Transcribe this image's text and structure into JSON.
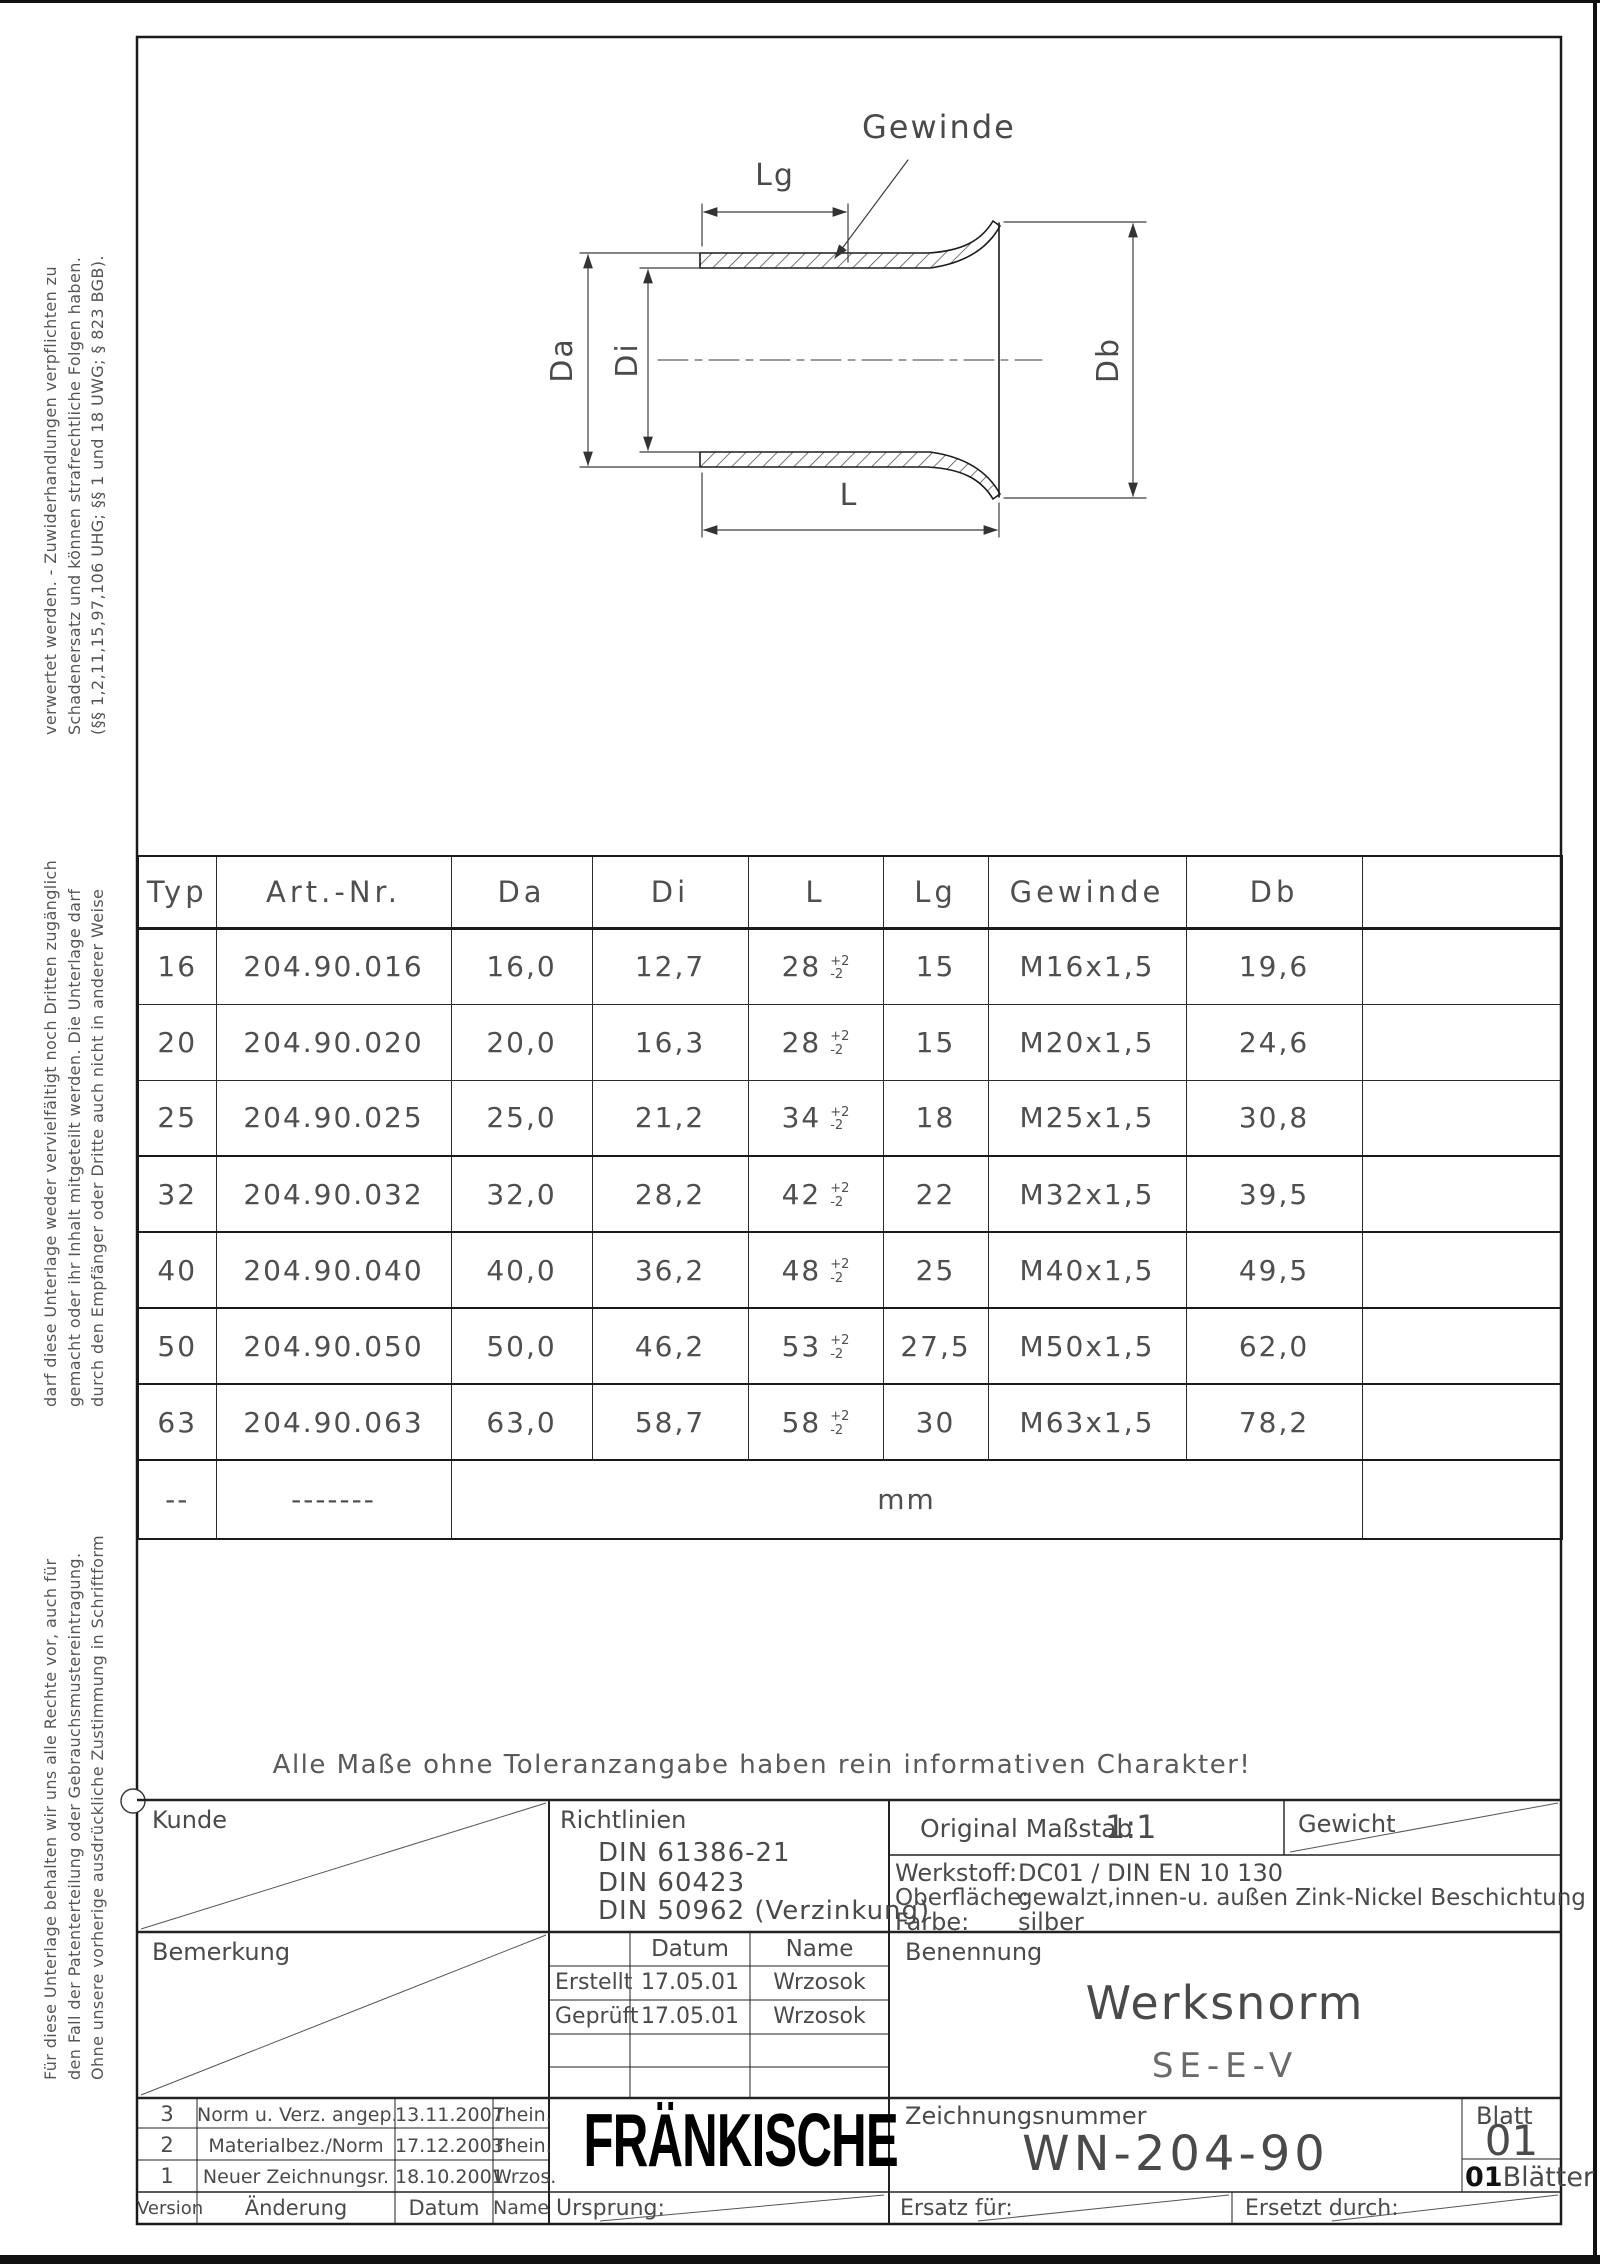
{
  "sheet": {
    "note": "Alle Maße ohne Toleranzangabe haben rein informativen Charakter!"
  },
  "margin_notes": {
    "top_block": [
      "verwertet werden. - Zuwiderhandlungen verpflichten zu",
      "Schadenersatz und können strafrechtliche Folgen haben.",
      "(§§ 1,2,11,15,97,106 UHG; §§ 1 und 18 UWG; § 823 BGB)."
    ],
    "middle_block": [
      "darf diese Unterlage weder vervielfältigt noch Dritten zugänglich",
      "gemacht oder ihr Inhalt mitgeteilt werden. Die Unterlage darf",
      "durch den Empfänger oder Dritte auch nicht in anderer Weise"
    ],
    "bottom_block": [
      "Für diese Unterlage behalten wir uns alle Rechte vor, auch für",
      "den Fall der Patenterteilung oder Gebrauchsmustereintragung.",
      "Ohne unsere vorherige ausdrückliche Zustimmung in Schriftform"
    ]
  },
  "drawing": {
    "labels": {
      "gewinde": "Gewinde",
      "lg": "Lg",
      "da": "Da",
      "di": "Di",
      "db": "Db",
      "l": "L"
    }
  },
  "table": {
    "headers": {
      "typ": "Typ",
      "art_nr": "Art.-Nr.",
      "da": "Da",
      "di": "Di",
      "l": "L",
      "lg": "Lg",
      "gewinde": "Gewinde",
      "db": "Db"
    },
    "l_tol_plus": "+2",
    "l_tol_minus": "-2",
    "rows": [
      {
        "typ": "16",
        "art_nr": "204.90.016",
        "da": "16,0",
        "di": "12,7",
        "l": "28",
        "lg": "15",
        "gewinde": "M16x1,5",
        "db": "19,6"
      },
      {
        "typ": "20",
        "art_nr": "204.90.020",
        "da": "20,0",
        "di": "16,3",
        "l": "28",
        "lg": "15",
        "gewinde": "M20x1,5",
        "db": "24,6"
      },
      {
        "typ": "25",
        "art_nr": "204.90.025",
        "da": "25,0",
        "di": "21,2",
        "l": "34",
        "lg": "18",
        "gewinde": "M25x1,5",
        "db": "30,8"
      },
      {
        "typ": "32",
        "art_nr": "204.90.032",
        "da": "32,0",
        "di": "28,2",
        "l": "42",
        "lg": "22",
        "gewinde": "M32x1,5",
        "db": "39,5"
      },
      {
        "typ": "40",
        "art_nr": "204.90.040",
        "da": "40,0",
        "di": "36,2",
        "l": "48",
        "lg": "25",
        "gewinde": "M40x1,5",
        "db": "49,5"
      },
      {
        "typ": "50",
        "art_nr": "204.90.050",
        "da": "50,0",
        "di": "46,2",
        "l": "53",
        "lg": "27,5",
        "gewinde": "M50x1,5",
        "db": "62,0"
      },
      {
        "typ": "63",
        "art_nr": "204.90.063",
        "da": "63,0",
        "di": "58,7",
        "l": "58",
        "lg": "30",
        "gewinde": "M63x1,5",
        "db": "78,2"
      }
    ],
    "footer": {
      "typ": "--",
      "art_nr": "-------",
      "unit": "mm"
    }
  },
  "title_block": {
    "kunde_label": "Kunde",
    "richtlinien_label": "Richtlinien",
    "richtlinien_items": [
      "DIN 61386-21",
      "DIN 60423",
      "DIN 50962 (Verzinkung)"
    ],
    "massstab_label": "Original Maßstab",
    "massstab_value": "1:1",
    "gewicht_label": "Gewicht",
    "werkstoff_label": "Werkstoff:",
    "werkstoff_value": "DC01 / DIN EN 10 130",
    "oberflaeche_label": "Oberfläche:",
    "oberflaeche_value": "gewalzt,innen-u. außen Zink-Nickel Beschichtung",
    "farbe_label": "Farbe:",
    "farbe_value": "silber",
    "bemerkung_label": "Bemerkung",
    "datum_label": "Datum",
    "name_label": "Name",
    "erstellt": {
      "label": "Erstellt",
      "datum": "17.05.01",
      "name": "Wrzosok"
    },
    "geprueft": {
      "label": "Geprüft",
      "datum": "17.05.01",
      "name": "Wrzosok"
    },
    "benennung_label": "Benennung",
    "benennung_title": "Werksnorm",
    "benennung_subtitle": "SE-E-V",
    "revisions": [
      {
        "version": "3",
        "aenderung": "Norm u. Verz. angep.",
        "datum": "13.11.2007",
        "name": "Thein."
      },
      {
        "version": "2",
        "aenderung": "Materialbez./Norm",
        "datum": "17.12.2003",
        "name": "Thein."
      },
      {
        "version": "1",
        "aenderung": "Neuer Zeichnungsr.",
        "datum": "18.10.2001",
        "name": "Wrzos."
      }
    ],
    "version_label": "Version",
    "aenderung_label": "Änderung",
    "datum_footer_label": "Datum",
    "name_footer_label": "Name",
    "ursprung_label": "Ursprung:",
    "logo": "FRÄNKISCHE",
    "zeichnungsnummer_label": "Zeichnungsnummer",
    "zeichnungsnummer": "WN-204-90",
    "ersatz_label": "Ersatz für:",
    "ersetzt_label": "Ersetzt durch:",
    "blatt_label": "Blatt",
    "blatt_value": "01",
    "blaetter_value": "01",
    "blaetter_label": "Blätter"
  }
}
